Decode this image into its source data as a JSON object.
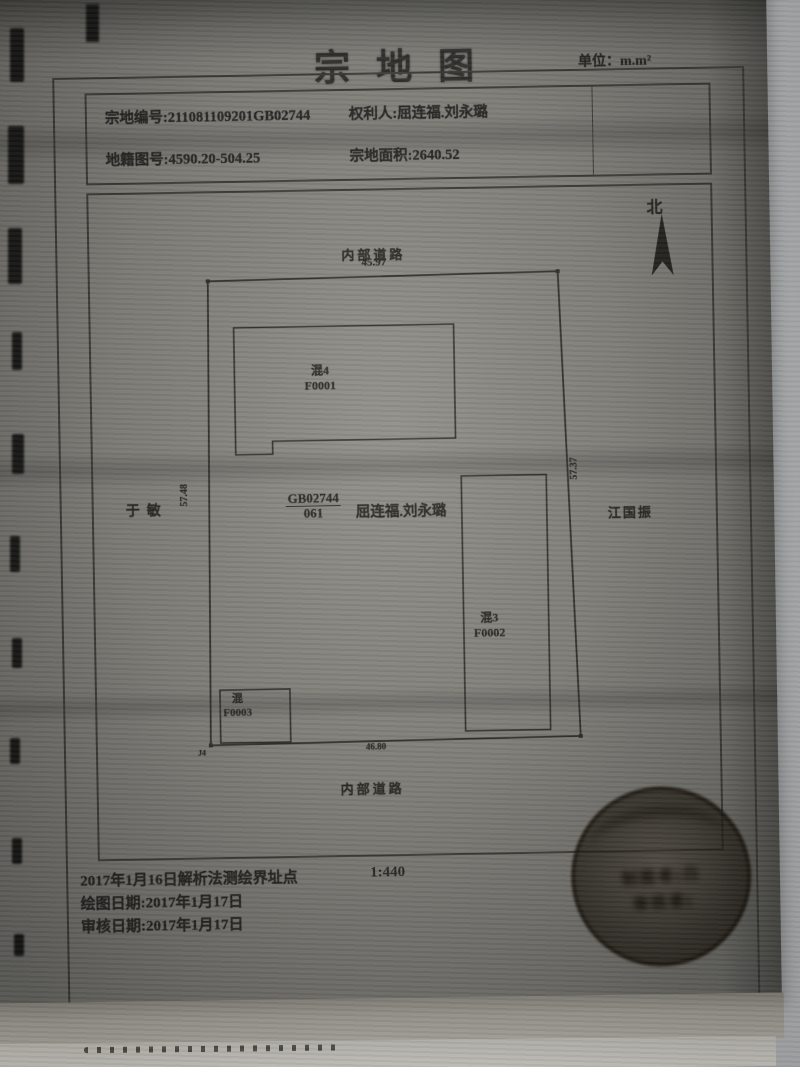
{
  "document": {
    "title": "宗地图",
    "unit": "单位：m.m²"
  },
  "header": {
    "parcel_no": "宗地编号:211081109201GB02744",
    "owner": "权利人:屈连福.刘永璐",
    "sheet_no": "地籍图号:4590.20-504.25",
    "area": "宗地面积:2640.52"
  },
  "map": {
    "north": "北",
    "road_top": "内部道路",
    "road_bottom": "内部道路",
    "dim_top": "45.97",
    "dim_bottom": "46.80",
    "dim_left": "57.48",
    "dim_right": "57.37",
    "neighbor_left": "于敏",
    "neighbor_right": "江国振",
    "corner_point": "J4",
    "parcel_code": "GB02744",
    "parcel_sub": "061",
    "parcel_owner": "屈连福.刘永璐",
    "buildings": [
      {
        "type": "混4",
        "code": "F0001"
      },
      {
        "type": "混3",
        "code": "F0002"
      },
      {
        "type": "混",
        "code": "F0003"
      }
    ]
  },
  "footer": {
    "survey_note": "2017年1月16日解析法测绘界址点",
    "scale": "1:440",
    "draw_date": "绘图日期:2017年1月17日",
    "audit_date": "审核日期:2017年1月17日"
  },
  "seal": {
    "line1": "制图者(白",
    "line2": "审核者("
  },
  "colors": {
    "paper": "#82817b",
    "ink": "#23221f"
  }
}
